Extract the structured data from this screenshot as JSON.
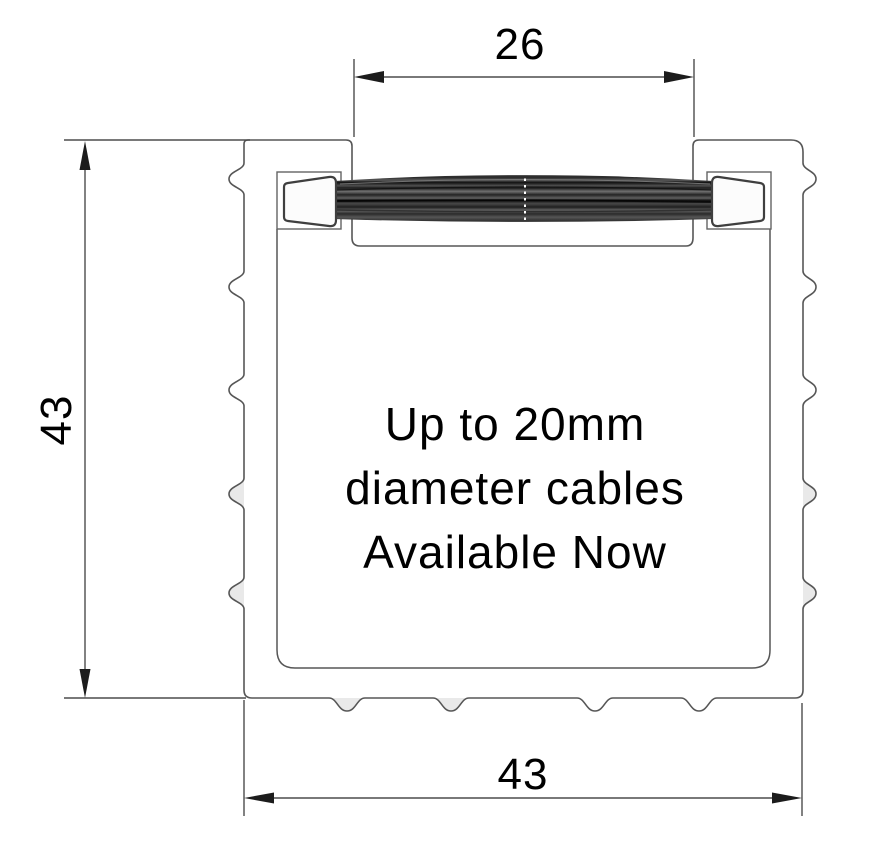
{
  "dimensions": {
    "top_width": "26",
    "left_height": "43",
    "bottom_width": "43"
  },
  "note": {
    "line1": "Up to 20mm",
    "line2": "diameter cables",
    "line3": "Available Now"
  },
  "colors": {
    "background": "#ffffff",
    "profile_line": "#565656",
    "dimension_line": "#4d4d4d",
    "arrow_fill": "#1c1c1c",
    "text": "#000000",
    "bump_fill": "#e9e9e9",
    "ferrule_fill": "#fcfcfc",
    "bristle_dark": "#111111",
    "bristle_light": "#8f8f8f"
  }
}
